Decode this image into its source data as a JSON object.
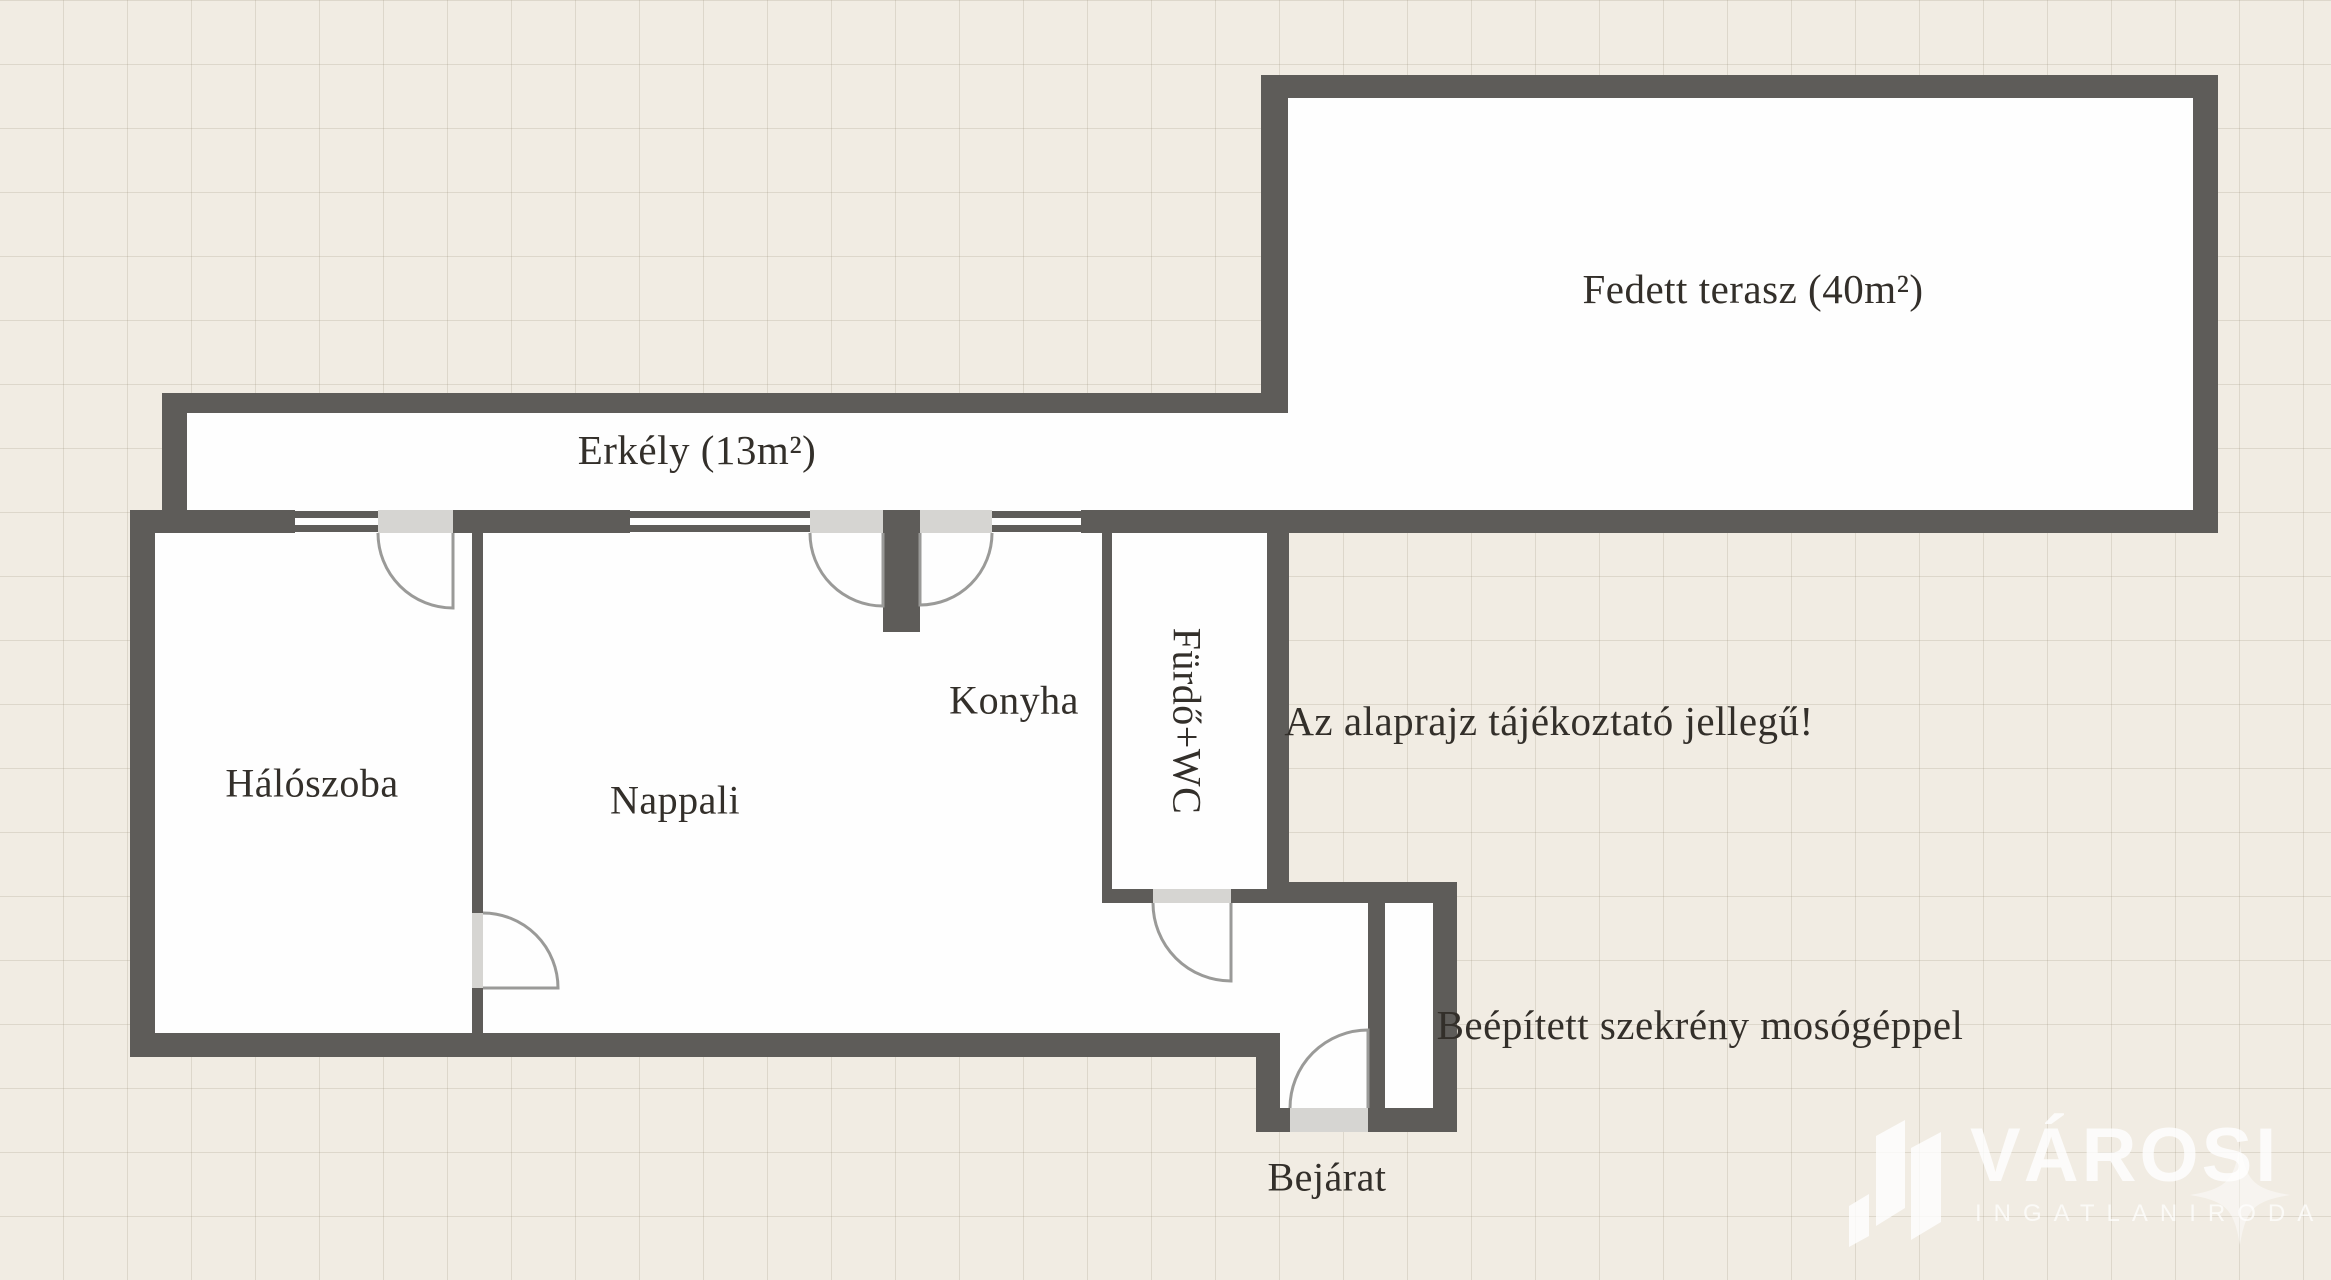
{
  "palette": {
    "background": "#f1ece3",
    "wall": "#5e5c59",
    "door_opening": "#d6d5d2",
    "interior": "#fefefe",
    "door_arc": "#9a9a98",
    "text": "#332f2a",
    "logo_white": "#ffffff"
  },
  "rooms": {
    "fedett_terasz": "Fedett terasz (40m²)",
    "erkely": "Erkély (13m²)",
    "haloszoba": "Hálószoba",
    "nappali": "Nappali",
    "konyha": "Konyha",
    "furdo_wc": "Fürdő+WC",
    "bejarat": "Bejárat"
  },
  "annotations": {
    "disclaimer": "Az alaprajz tájékoztató jellegű!",
    "closet": "Beépített szekrény mosógéppel"
  },
  "logo": {
    "brand": "VÁROSI",
    "subtitle": "INGATLANIRODA"
  }
}
